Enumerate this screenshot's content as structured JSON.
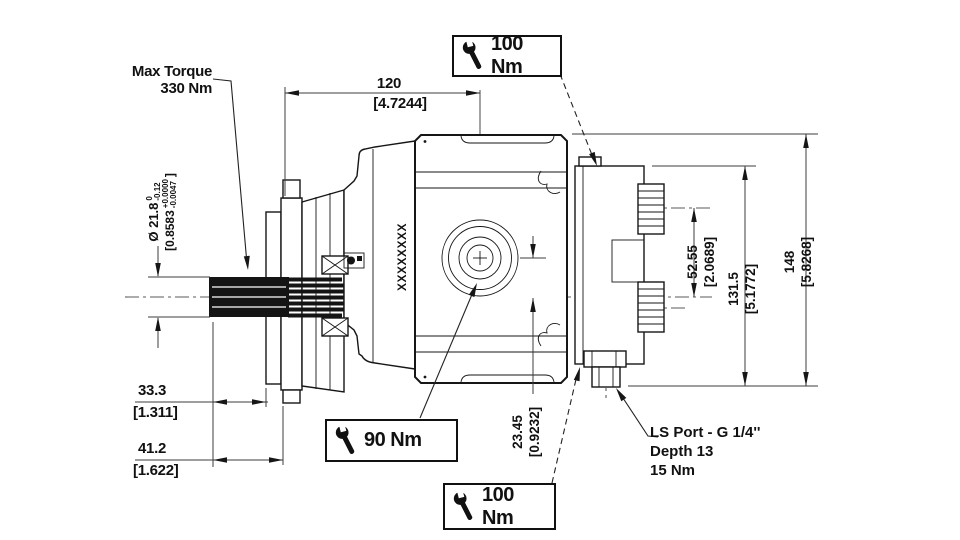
{
  "drawing": {
    "title_note": "hydraulic pump dimensional drawing",
    "colors": {
      "line": "#161616",
      "background": "#ffffff"
    },
    "labels": {
      "max_torque_line1": "Max Torque",
      "max_torque_line2": "330 Nm",
      "ls_port_line1": "LS Port - G 1/4''",
      "ls_port_line2": "Depth 13",
      "ls_port_line3": "15 Nm",
      "model_code": "XXXXXXXX"
    },
    "torque_callouts": {
      "top": "100 Nm",
      "front": "90 Nm",
      "bottom": "100 Nm"
    },
    "dimensions": {
      "width_mm": "120",
      "width_in": "[4.7244]",
      "shaft_dia_mm": "Ø 21.8",
      "shaft_dia_tol_hi": "0",
      "shaft_dia_tol_lo": "-0.12",
      "shaft_dia_in_open": "[0.8583",
      "shaft_dia_in_hi": "+0.0000",
      "shaft_dia_in_lo": "-0.0047",
      "shaft_dia_in_close": "]",
      "spline_mm": "33.3",
      "spline_in": "[1.311]",
      "shaft_len_mm": "41.2",
      "shaft_len_in": "[1.622]",
      "port_offset_mm": "23.45",
      "port_offset_in": "[0.9232]",
      "ls_offset_mm": "52.55",
      "ls_offset_in": "[2.0689]",
      "cap_height_mm": "131.5",
      "cap_height_in": "[5.1772]",
      "total_height_mm": "148",
      "total_height_in": "[5.8268]"
    }
  }
}
